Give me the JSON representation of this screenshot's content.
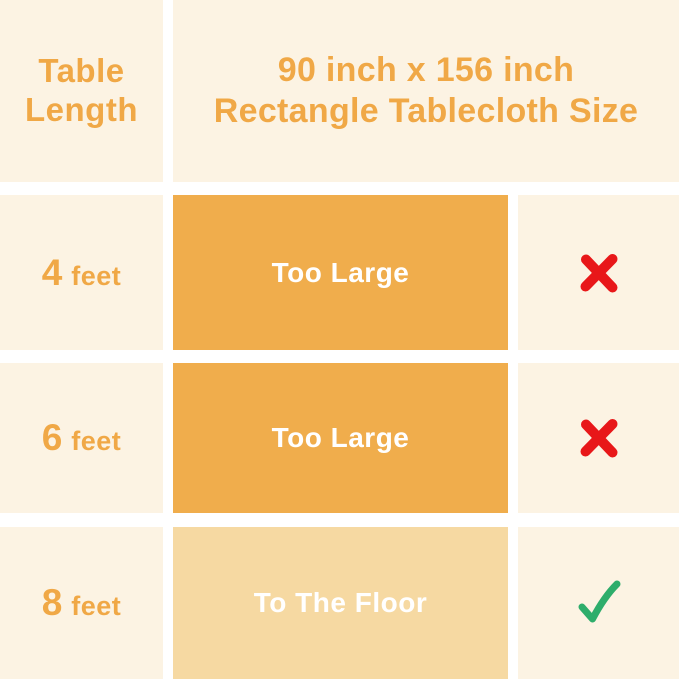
{
  "palette": {
    "gutter_white": "#FFFFFF",
    "cell_cream": "#FCF3E3",
    "rect_orange": "#F0AD4C",
    "rect_light_orange": "#F6D9A2",
    "text_orange": "#F0A846",
    "rect_text_white": "#FFFFFF",
    "cross_red": "#E81719",
    "check_green": "#2EAD6B"
  },
  "header": {
    "row_header": "Table\nLength",
    "title": "90 inch x 156 inch\nRectangle Tablecloth Size"
  },
  "rows": [
    {
      "length_value": "4",
      "length_unit": "feet",
      "fit_label": "Too Large",
      "verdict": "no",
      "verdict_icon": "cross-icon"
    },
    {
      "length_value": "6",
      "length_unit": "feet",
      "fit_label": "Too Large",
      "verdict": "no",
      "verdict_icon": "cross-icon"
    },
    {
      "length_value": "8",
      "length_unit": "feet",
      "fit_label": "To The Floor",
      "verdict": "yes",
      "verdict_icon": "check-icon"
    }
  ],
  "chart_data": {
    "type": "table",
    "title": "90 inch x 156 inch Rectangle Tablecloth Size",
    "columns": [
      "Table Length",
      "90 inch x 156 inch Rectangle Tablecloth Size",
      "Verdict"
    ],
    "rows": [
      [
        "4 feet",
        "Too Large",
        "no"
      ],
      [
        "6 feet",
        "Too Large",
        "no"
      ],
      [
        "8 feet",
        "To The Floor",
        "yes"
      ]
    ],
    "legend_position": "none",
    "grid": false
  }
}
